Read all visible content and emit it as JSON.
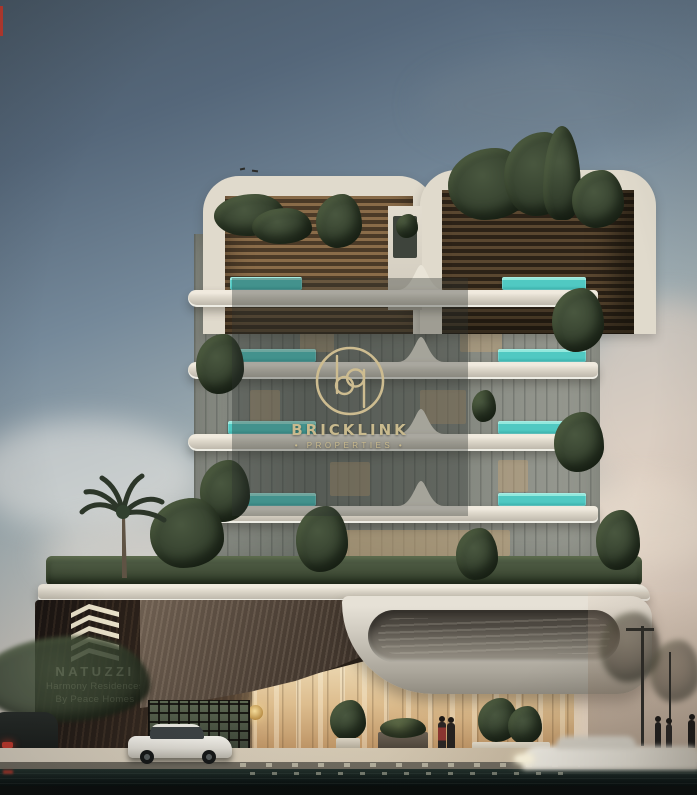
{
  "watermark": {
    "monogram": "bp",
    "brand": "BRICKLINK",
    "tagline": "• PROPERTIES •"
  },
  "signboard": {
    "brand": "NATUZZI",
    "subtitle1": "Harmony Residences",
    "subtitle2": "By Peace Homes"
  },
  "colors": {
    "watermark_gold": "#c9ba8e",
    "pool_teal": "#50c9c2",
    "signage_cream": "#eae2cb",
    "sky_top": "#485765",
    "sky_warm": "#e3d2c2",
    "balcony_white": "#dbd5c8",
    "podium_wood": "#2d231b"
  }
}
